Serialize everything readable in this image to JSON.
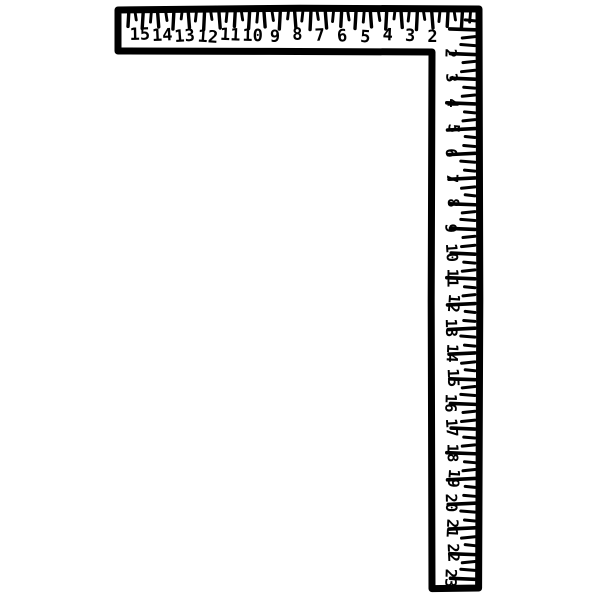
{
  "square": {
    "ink_color": "#000000",
    "paper_color": "#ffffff",
    "horizontal_scale": {
      "labels": [
        "15",
        "14",
        "13",
        "12",
        "11",
        "10",
        "9",
        "8",
        "7",
        "6",
        "5",
        "4",
        "3",
        "2"
      ]
    },
    "vertical_scale": {
      "labels": [
        "2",
        "3",
        "4",
        "5",
        "6",
        "7",
        "8",
        "9",
        "10",
        "11",
        "12",
        "13",
        "14",
        "15",
        "16",
        "17",
        "18",
        "19",
        "20",
        "21",
        "22",
        "23"
      ]
    }
  }
}
